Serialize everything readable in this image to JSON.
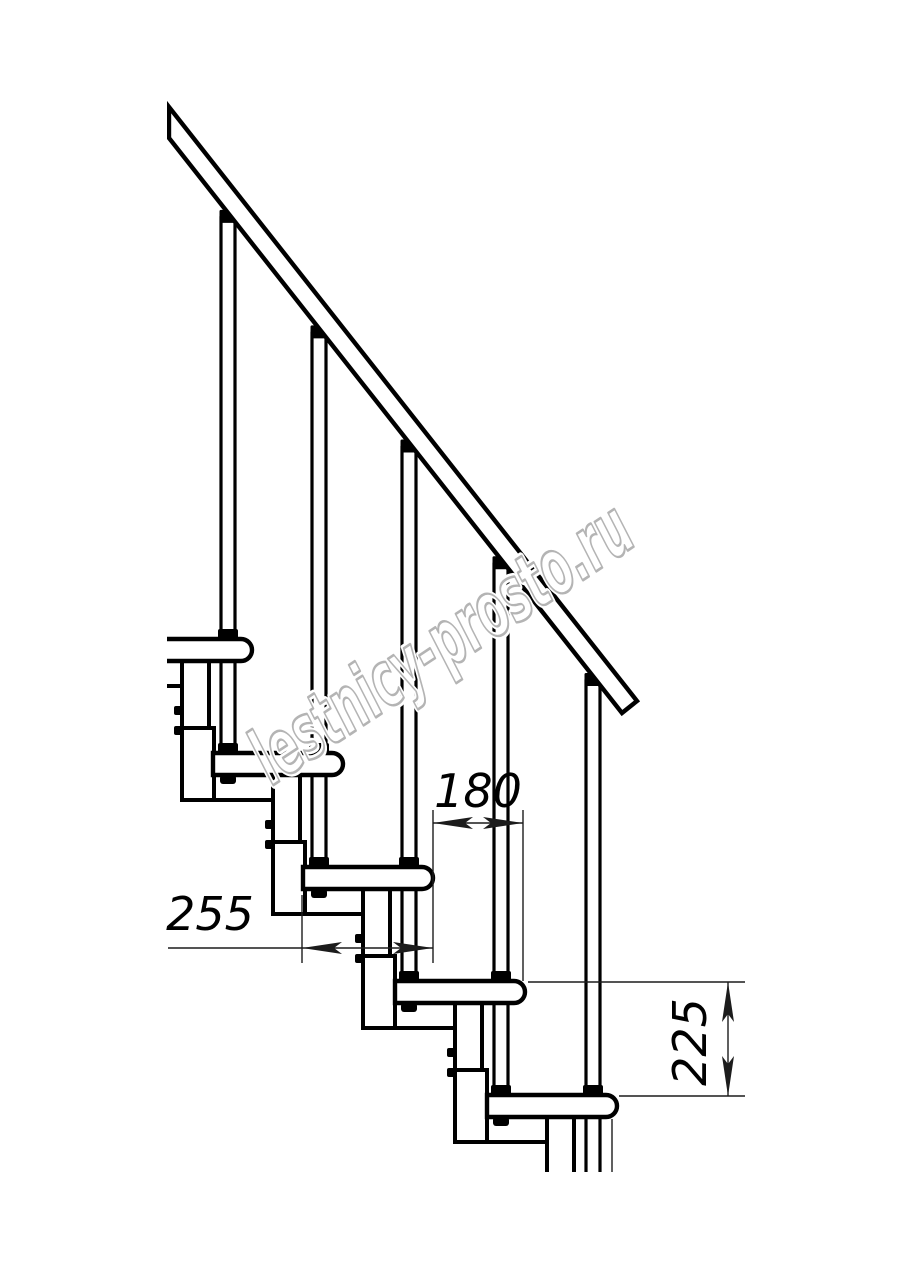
{
  "meta": {
    "type": "technical-drawing",
    "subject": "modular staircase side elevation with railing"
  },
  "drawing": {
    "background": "#ffffff",
    "line_color": "#000000",
    "dim_color": "#1c1c1c",
    "watermark": {
      "text": "lestnicy-prosto.ru",
      "color": "#b4b4b4",
      "halo": "#ffffff",
      "x": 272,
      "y": 786,
      "angle": -33.5,
      "font_size": 77,
      "text_length": 440
    },
    "geometry": {
      "canvas": {
        "w": 914,
        "h": 1280
      },
      "step_count": 5,
      "noses": [
        252,
        343,
        433,
        525,
        617
      ],
      "tread_tops": [
        639,
        753,
        867,
        981,
        1095
      ],
      "tread_len": 130,
      "tread_h": 22,
      "pipe_offset": 24,
      "pipe_w": 14,
      "rail": {
        "points": [
          [
            169,
            107
          ],
          [
            637,
            701
          ],
          [
            622,
            713
          ],
          [
            169,
            138
          ]
        ],
        "x0": 169,
        "y0": 138,
        "slope": 1.269
      },
      "cut_left": 167,
      "cut_bottom": 1172,
      "extra_ext_line": {
        "x": 612,
        "y1": 1119,
        "y2": 1172
      }
    },
    "dimensions": [
      {
        "label": "180",
        "orient": "h",
        "line": {
          "x1": 433,
          "y1": 823,
          "x2": 523,
          "y2": 823
        },
        "arrows": [
          {
            "x": 433,
            "y": 823,
            "dir": "left"
          },
          {
            "x": 523,
            "y": 823,
            "dir": "right"
          }
        ],
        "ext": [
          {
            "x1": 433,
            "y1": 810,
            "x2": 433,
            "y2": 963
          },
          {
            "x1": 523,
            "y1": 810,
            "x2": 523,
            "y2": 981
          }
        ],
        "text": {
          "x": 478,
          "y": 807,
          "rotate": 0
        }
      },
      {
        "label": "255",
        "orient": "h",
        "line": {
          "x1": 168,
          "y1": 948,
          "x2": 433,
          "y2": 948
        },
        "arrows": [
          {
            "x": 302,
            "y": 948,
            "dir": "left"
          },
          {
            "x": 433,
            "y": 948,
            "dir": "right"
          }
        ],
        "ext": [
          {
            "x1": 302,
            "y1": 895,
            "x2": 302,
            "y2": 963
          }
        ],
        "text": {
          "x": 210,
          "y": 930,
          "rotate": 0
        }
      },
      {
        "label": "225",
        "orient": "v",
        "line": {
          "x1": 728,
          "y1": 982,
          "x2": 728,
          "y2": 1096
        },
        "arrows": [
          {
            "x": 728,
            "y": 982,
            "dir": "up"
          },
          {
            "x": 728,
            "y": 1096,
            "dir": "down"
          }
        ],
        "ext": [
          {
            "x1": 528,
            "y1": 982,
            "x2": 745,
            "y2": 982
          },
          {
            "x1": 619,
            "y1": 1096,
            "x2": 745,
            "y2": 1096
          }
        ],
        "text": {
          "x": 706,
          "y": 1042,
          "rotate": -90
        }
      }
    ]
  }
}
